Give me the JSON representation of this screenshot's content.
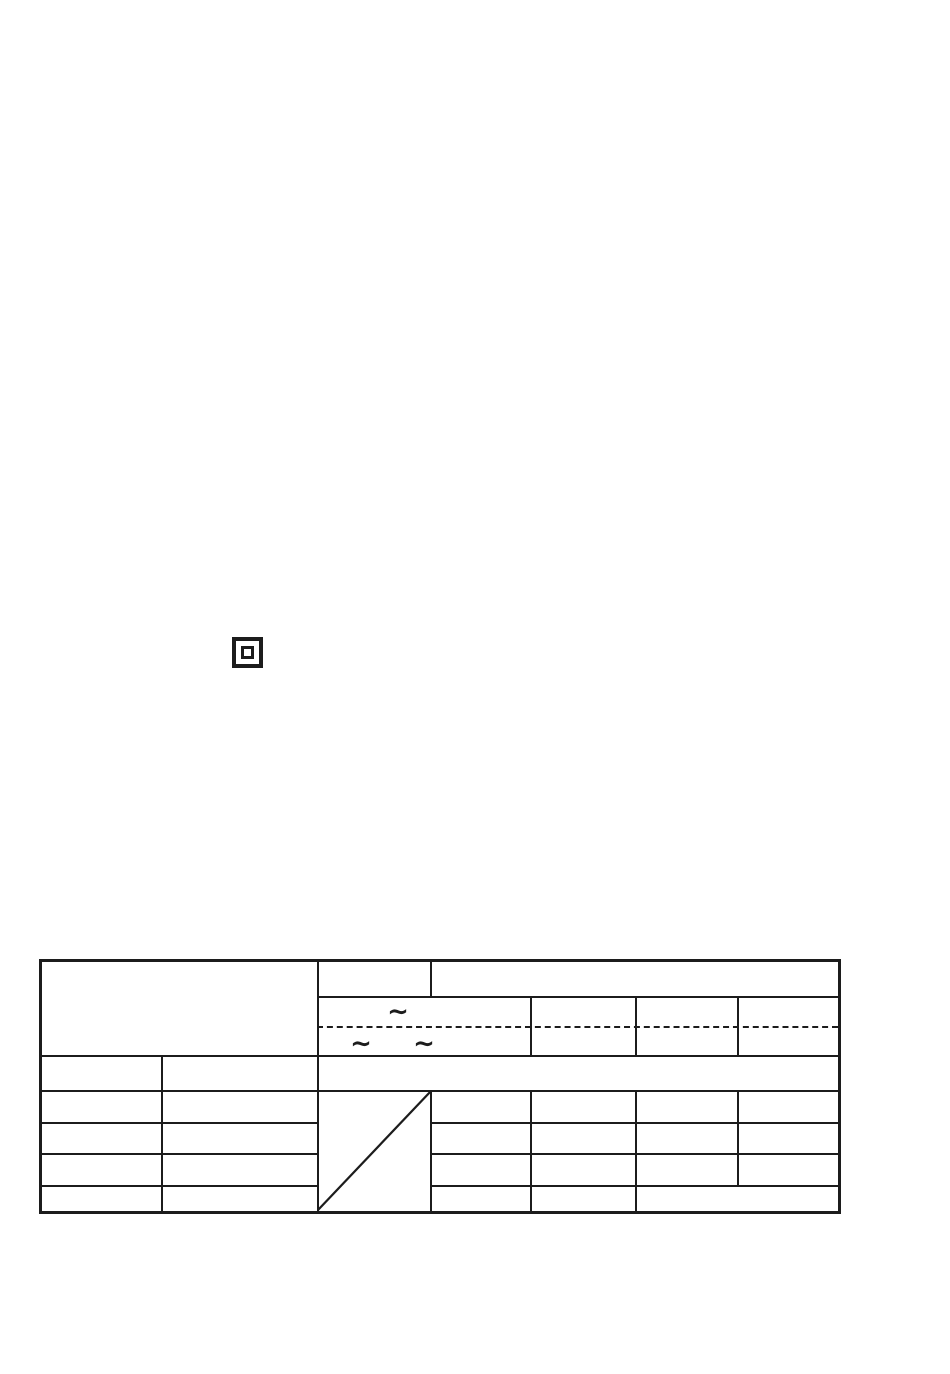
{
  "page": {
    "background_color": "#ffffff",
    "ink_color": "#1c1c1c"
  },
  "symbols": {
    "class_ii_insulation_icon": {
      "name": "class-ii-double-insulation",
      "shape": "square-within-square"
    }
  },
  "spec_table": {
    "ac_symbols": {
      "single": "∼",
      "pair_left": "∼",
      "pair_right": "∼"
    },
    "separator_style": "dashed",
    "diagonal_cell": "blank-slash",
    "cell_text": ""
  }
}
